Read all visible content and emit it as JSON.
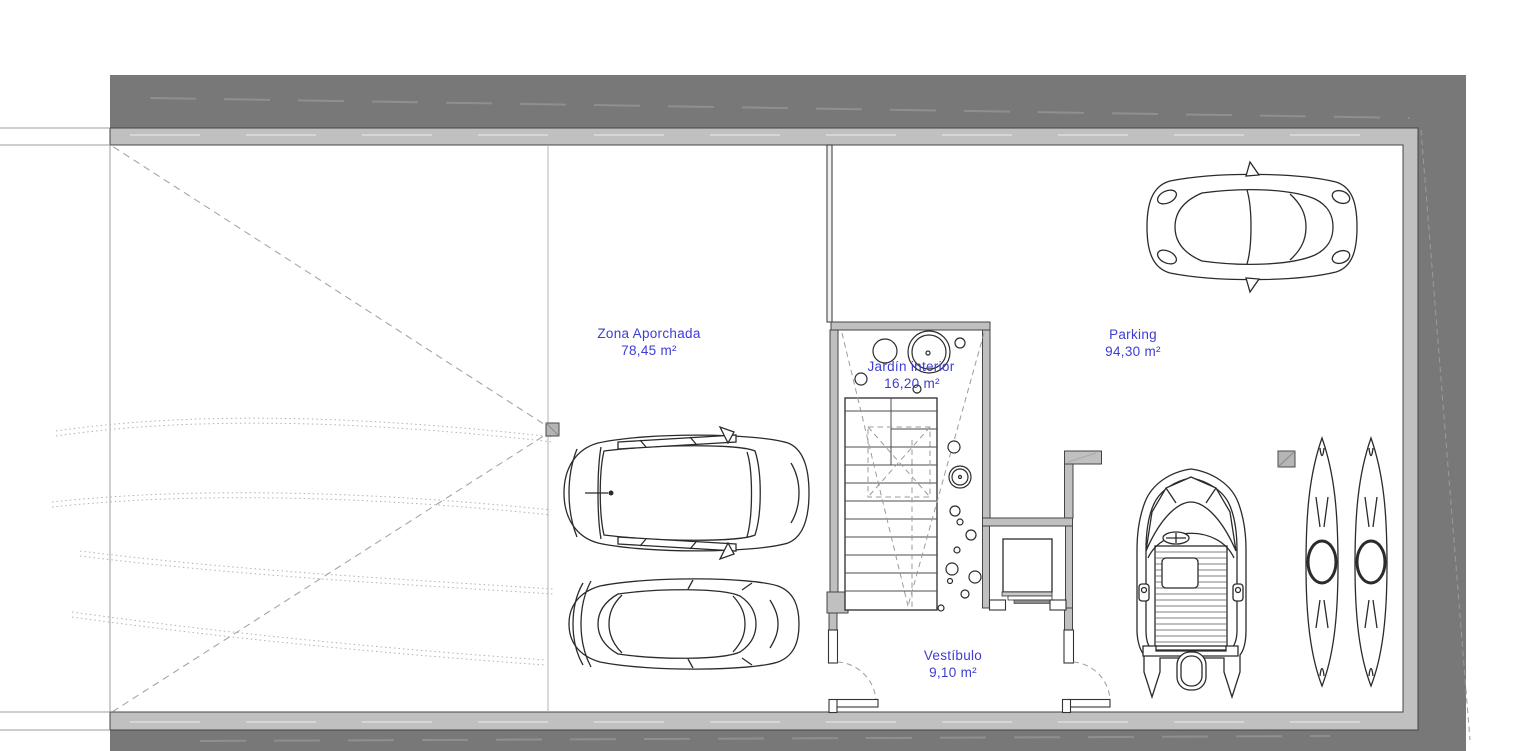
{
  "zones": [
    {
      "name": "Zona Aporchada",
      "area": "78,45 m²"
    },
    {
      "name": "Parking",
      "area": "94,30 m²"
    },
    {
      "name": "Jardín interior",
      "area": "16,20 m²"
    },
    {
      "name": "Vestíbulo",
      "area": "9,10 m²"
    }
  ],
  "colors": {
    "label-blue": "#3d3dd2",
    "band-dark": "#787878",
    "wall-light": "#c0c0c0",
    "line-dark": "#2b2b2b"
  }
}
